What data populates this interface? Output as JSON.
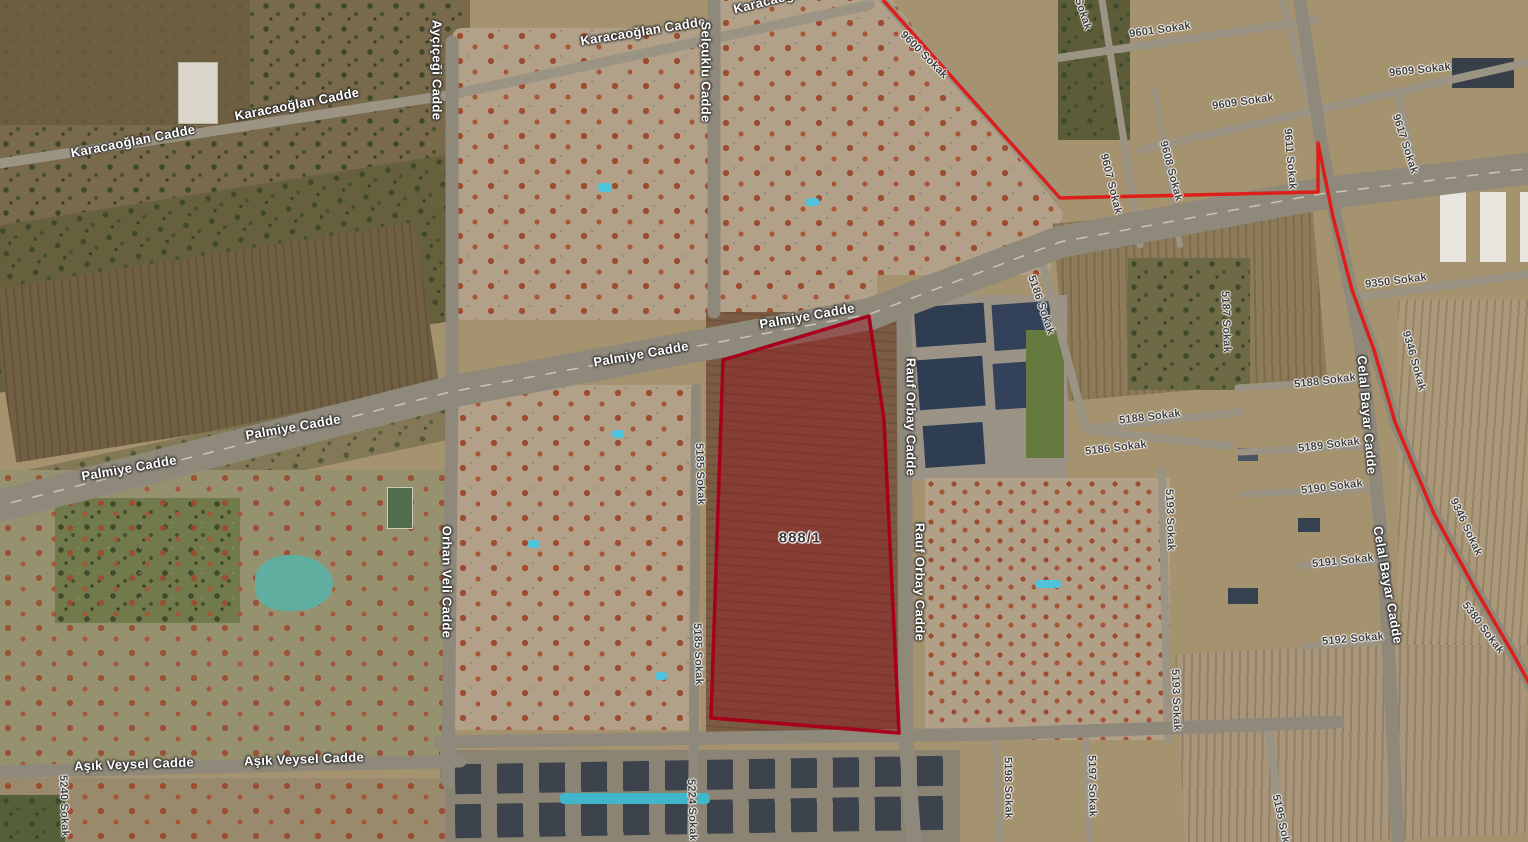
{
  "map": {
    "type": "satellite-map-view",
    "parcel": {
      "label": "888/1",
      "points": "869,316 884,420 899,733 711,718 723,360",
      "fill": "rgba(150,20,30,0.42)",
      "stroke": "#a8001c"
    },
    "boundary": {
      "points": "883,0 1060,198 1318,192 1318,143 1333,217 1352,290 1374,350 1395,422 1434,514 1474,587 1512,652 1530,685",
      "color": "#dd1f1a"
    },
    "labels": [
      {
        "text": "Karacaoğlan Cadde",
        "x": 133,
        "y": 141,
        "rot": -11,
        "kind": "major"
      },
      {
        "text": "Karacaoğlan Cadde",
        "x": 297,
        "y": 104,
        "rot": -11,
        "kind": "major"
      },
      {
        "text": "Karacaoğlan Cadde",
        "x": 643,
        "y": 31,
        "rot": -9,
        "kind": "major"
      },
      {
        "text": "Karacaoğlan Cadde",
        "x": 795,
        "y": -6,
        "rot": -14,
        "kind": "major"
      },
      {
        "text": "Ayçiçeği Cadde",
        "x": 437,
        "y": 70,
        "rot": 90,
        "kind": "major"
      },
      {
        "text": "Selçuklu Cadde",
        "x": 706,
        "y": 72,
        "rot": 90,
        "kind": "major"
      },
      {
        "text": "Palmiye Cadde",
        "x": 807,
        "y": 316,
        "rot": -10,
        "kind": "major"
      },
      {
        "text": "Palmiye Cadde",
        "x": 641,
        "y": 354,
        "rot": -10,
        "kind": "major"
      },
      {
        "text": "Palmiye Cadde",
        "x": 293,
        "y": 427,
        "rot": -10,
        "kind": "major"
      },
      {
        "text": "Palmiye Cadde",
        "x": 129,
        "y": 468,
        "rot": -10,
        "kind": "major"
      },
      {
        "text": "Orhan Veli Cadde",
        "x": 447,
        "y": 582,
        "rot": 90,
        "kind": "major"
      },
      {
        "text": "Rauf Orbay Cadde",
        "x": 911,
        "y": 417,
        "rot": 90,
        "kind": "major"
      },
      {
        "text": "Rauf Orbay Cadde",
        "x": 920,
        "y": 582,
        "rot": 90,
        "kind": "major"
      },
      {
        "text": "Aşık Veysel Cadde",
        "x": 134,
        "y": 764,
        "rot": -2,
        "kind": "major"
      },
      {
        "text": "Aşık Veysel Cadde",
        "x": 304,
        "y": 759,
        "rot": -2,
        "kind": "major"
      },
      {
        "text": "Celal Bayar Cadde",
        "x": 1367,
        "y": 415,
        "rot": 85,
        "kind": "major"
      },
      {
        "text": "Celal Bayar Cadde",
        "x": 1388,
        "y": 585,
        "rot": 80,
        "kind": "major"
      },
      {
        "text": "9600 Sokak",
        "x": 924,
        "y": 55,
        "rot": 45,
        "kind": "minor"
      },
      {
        "text": "Sokak",
        "x": 1083,
        "y": 14,
        "rot": 72,
        "kind": "minor"
      },
      {
        "text": "9601 Sokak",
        "x": 1160,
        "y": 30,
        "rot": -8,
        "kind": "minor"
      },
      {
        "text": "9609 Sokak",
        "x": 1420,
        "y": 70,
        "rot": -6,
        "kind": "minor"
      },
      {
        "text": "9609 Sokak",
        "x": 1243,
        "y": 102,
        "rot": -8,
        "kind": "minor"
      },
      {
        "text": "9607 Sokak",
        "x": 1111,
        "y": 184,
        "rot": 76,
        "kind": "minor"
      },
      {
        "text": "9608 Sokak",
        "x": 1171,
        "y": 171,
        "rot": 75,
        "kind": "minor"
      },
      {
        "text": "9611 Sokak",
        "x": 1290,
        "y": 159,
        "rot": 85,
        "kind": "minor"
      },
      {
        "text": "9617 Sokak",
        "x": 1405,
        "y": 144,
        "rot": 72,
        "kind": "minor"
      },
      {
        "text": "9350 Sokak",
        "x": 1396,
        "y": 281,
        "rot": -7,
        "kind": "minor"
      },
      {
        "text": "9346 Sokak",
        "x": 1414,
        "y": 361,
        "rot": 74,
        "kind": "minor"
      },
      {
        "text": "9346 Sokak",
        "x": 1466,
        "y": 527,
        "rot": 65,
        "kind": "minor"
      },
      {
        "text": "5380 Sokak",
        "x": 1483,
        "y": 628,
        "rot": 53,
        "kind": "minor"
      },
      {
        "text": "5186 Sokak",
        "x": 1041,
        "y": 305,
        "rot": 71,
        "kind": "minor"
      },
      {
        "text": "5187 Sokak",
        "x": 1226,
        "y": 322,
        "rot": 88,
        "kind": "minor"
      },
      {
        "text": "5188 Sokak",
        "x": 1150,
        "y": 417,
        "rot": -7,
        "kind": "minor"
      },
      {
        "text": "5186 Sokak",
        "x": 1116,
        "y": 448,
        "rot": -7,
        "kind": "minor"
      },
      {
        "text": "5188 Sokak",
        "x": 1325,
        "y": 381,
        "rot": -7,
        "kind": "minor"
      },
      {
        "text": "5189 Sokak",
        "x": 1329,
        "y": 445,
        "rot": -7,
        "kind": "minor"
      },
      {
        "text": "5190 Sokak",
        "x": 1332,
        "y": 487,
        "rot": -7,
        "kind": "minor"
      },
      {
        "text": "5191 Sokak",
        "x": 1343,
        "y": 561,
        "rot": -6,
        "kind": "minor"
      },
      {
        "text": "5192 Sokak",
        "x": 1353,
        "y": 639,
        "rot": -5,
        "kind": "minor"
      },
      {
        "text": "5193 Sokak",
        "x": 1170,
        "y": 520,
        "rot": 88,
        "kind": "minor"
      },
      {
        "text": "5193 Sokak",
        "x": 1176,
        "y": 700,
        "rot": 88,
        "kind": "minor"
      },
      {
        "text": "5185 Sokak",
        "x": 700,
        "y": 474,
        "rot": 88,
        "kind": "minor"
      },
      {
        "text": "5185 Sokak",
        "x": 698,
        "y": 654,
        "rot": 88,
        "kind": "minor"
      },
      {
        "text": "5240 Sokak",
        "x": 64,
        "y": 806,
        "rot": 88,
        "kind": "minor"
      },
      {
        "text": "5224 Sokak",
        "x": 692,
        "y": 810,
        "rot": 88,
        "kind": "minor"
      },
      {
        "text": "5198 Sokak",
        "x": 1008,
        "y": 788,
        "rot": 89,
        "kind": "minor"
      },
      {
        "text": "5197 Sokak",
        "x": 1092,
        "y": 786,
        "rot": 89,
        "kind": "minor"
      },
      {
        "text": "5195 Sokak",
        "x": 1282,
        "y": 825,
        "rot": 78,
        "kind": "minor"
      }
    ]
  }
}
